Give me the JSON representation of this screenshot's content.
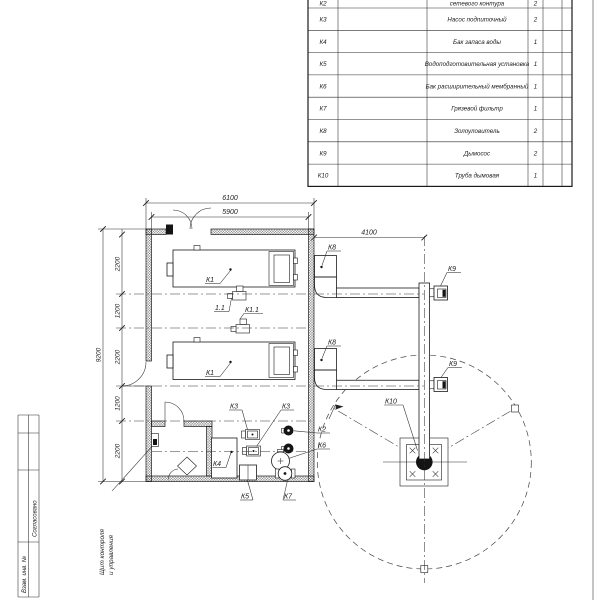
{
  "sheet": {
    "agreed": "Согласовано",
    "inv": "Взам. инв. №"
  },
  "note": {
    "line1": "Щит контроля",
    "line2": "и управления"
  },
  "dims": {
    "top_outer": "6100",
    "top_inner": "5900",
    "height": "9200",
    "seg1": "2200",
    "seg2": "1200",
    "seg3": "2200",
    "seg4": "1200",
    "seg5": "2200",
    "flue": "4100"
  },
  "labels": {
    "k1_top": "К1",
    "k1_bottom": "К1",
    "pump_top": "1.1",
    "pump_mid": "К1.1",
    "k8_top": "К8",
    "k8_bottom": "К8",
    "k9_top": "К9",
    "k9_bottom": "К9",
    "k10": "К10",
    "k3_left": "К3",
    "k3_right": "К3",
    "k2": "К2",
    "k4": "К4",
    "k5": "К5",
    "k6": "К6",
    "k7": "К7"
  },
  "table": {
    "rows": [
      {
        "pos": "К2",
        "name": "сетевого контура",
        "qty": "2"
      },
      {
        "pos": "К3",
        "name": "Насос подпиточный",
        "qty": "2"
      },
      {
        "pos": "К4",
        "name": "Бак запаса воды",
        "qty": "1"
      },
      {
        "pos": "К5",
        "name": "Водоподготовительная установка",
        "qty": "1"
      },
      {
        "pos": "К6",
        "name": "Бак расширительный мембранный",
        "qty": "1"
      },
      {
        "pos": "К7",
        "name": "Грязевой фильтр",
        "qty": "1"
      },
      {
        "pos": "К8",
        "name": "Золоуловитель",
        "qty": "2"
      },
      {
        "pos": "К9",
        "name": "Дымосос",
        "qty": "2"
      },
      {
        "pos": "К10",
        "name": "Труба дымовая",
        "qty": "1"
      }
    ]
  }
}
